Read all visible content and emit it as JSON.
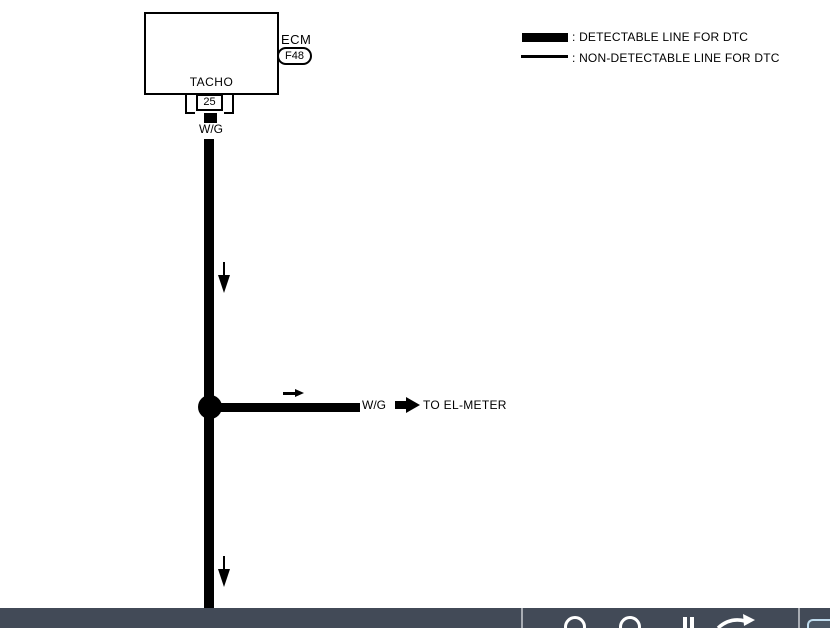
{
  "diagram": {
    "component_label": "ECM",
    "connector_code": "F48",
    "terminal_name": "TACHO",
    "pin_number": "25",
    "wire_label_top": "W/G",
    "branch_wire_label": "W/G",
    "branch_destination": "TO EL-METER"
  },
  "legend": {
    "detectable_label": ": DETECTABLE LINE FOR DTC",
    "non_detectable_label": ": NON-DETECTABLE LINE FOR DTC"
  },
  "toolbar": {
    "background_color": "#424A57",
    "icon_color": "#FFFFFF",
    "divider_color": "#A8ACB3",
    "highlight_color": "#BFDCEE",
    "icons": [
      {
        "name": "zoom-out-icon"
      },
      {
        "name": "zoom-in-icon"
      },
      {
        "name": "pause-bars-icon"
      },
      {
        "name": "redo-arrow-icon"
      }
    ]
  },
  "colors": {
    "diagram_ink": "#000000",
    "page_background": "#FFFFFF"
  }
}
